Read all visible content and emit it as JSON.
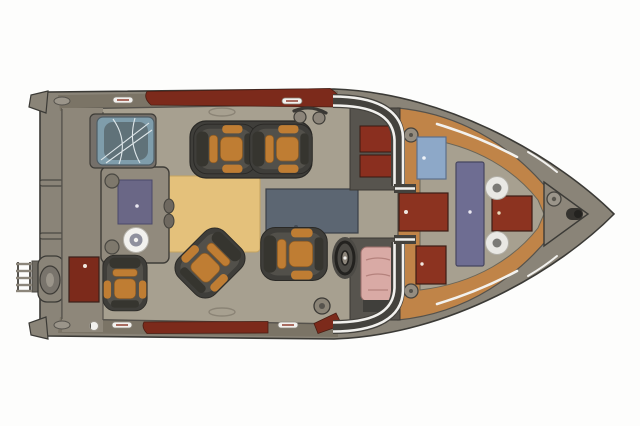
{
  "scene": {
    "type": "boat-deck-floorplan",
    "view": "top-down",
    "orientation": "bow-right-stern-left"
  },
  "colors": {
    "background": "#fdfdfc",
    "hull": "#8a8478",
    "hull_outline": "#3b3a36",
    "gunwale_band": "#7b7466",
    "deck": "#a7a090",
    "stern_platform": "#8e877a",
    "console_gray": "#918a7d",
    "console_dark": "#57544e",
    "maroon": "#7c2a1b",
    "maroon_bright": "#8c3320",
    "maroon_edge": "#3c1d15",
    "seat_dark": "#3f3e3a",
    "seat_mid": "#52504a",
    "seat_back": "#36352f",
    "cushion": "#bf7d33",
    "cushion_edge": "#8a5a24",
    "tan_mat": "#e4c17b",
    "tan_edge": "#c5a361",
    "slate_pad": "#5c6672",
    "purple_counter": "#6a6786",
    "purple_table": "#6e6d92",
    "hatch_blue": "#8da8c8",
    "cover_blue": "#7f9dab",
    "pink_seat": "#d9aaa5",
    "pink_line": "#b5827d",
    "white_accent": "#f2f1ee",
    "orange_deck": "#c08448",
    "metal": "#9b958a",
    "metal_dark": "#6e6a62",
    "wheel": "#23221f",
    "frame_dark": "#44423d"
  },
  "parts": [
    "hull",
    "swim-platform",
    "boarding-ladder",
    "outboard-motor",
    "transom-handles",
    "stern-bench-with-cover",
    "galley-console",
    "sink-counter",
    "stove-burner",
    "cup-holders",
    "cooler",
    "dinette-mat",
    "back-to-back-seats",
    "swivel-seat",
    "companion-seat",
    "helm-seat",
    "steering-wheel",
    "sun-pad",
    "walkthrough-windshield",
    "port-console-dash",
    "helm-console",
    "walkthrough-door",
    "bow-hatch",
    "bow-seats",
    "bow-table",
    "pedestal-seat-bases",
    "cleats",
    "navigation-light",
    "bow-light",
    "hull-accent-stripes",
    "gunwale-inserts"
  ]
}
